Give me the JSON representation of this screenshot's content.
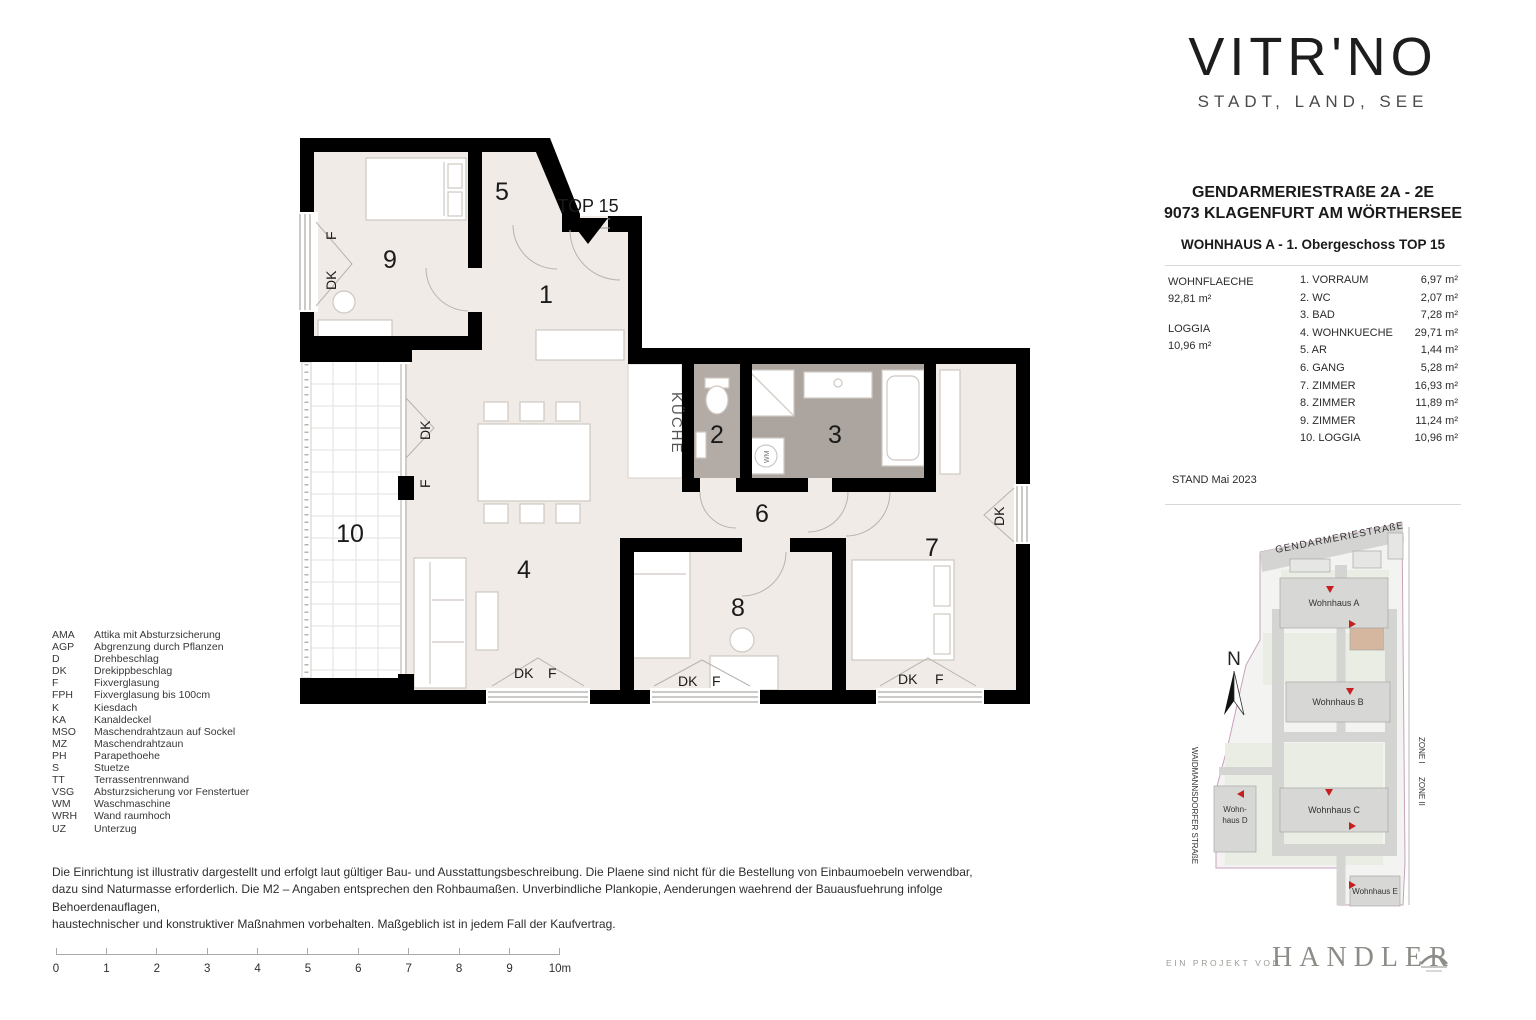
{
  "brand": {
    "name": "VITR'NO",
    "tagline": "STADT, LAND, SEE"
  },
  "title": {
    "line1": "GENDARMERIESTRAßE 2A - 2E",
    "line2": "9073 KLAGENFURT AM WÖRTHERSEE",
    "subtitle": "WOHNHAUS A - 1. Obergeschoss TOP 15"
  },
  "areas": {
    "wohnflaeche_label": "WOHNFLAECHE",
    "wohnflaeche_value": "92,81 m²",
    "loggia_label": "LOGGIA",
    "loggia_value": "10,96 m²"
  },
  "rooms": [
    {
      "name": "1. VORRAUM",
      "area": "6,97 m²"
    },
    {
      "name": "2. WC",
      "area": "2,07 m²"
    },
    {
      "name": "3. BAD",
      "area": "7,28 m²"
    },
    {
      "name": "4. WOHNKUECHE",
      "area": "29,71 m²"
    },
    {
      "name": "5. AR",
      "area": "1,44 m²"
    },
    {
      "name": "6. GANG",
      "area": "5,28 m²"
    },
    {
      "name": "7. ZIMMER",
      "area": "16,93 m²"
    },
    {
      "name": "8. ZIMMER",
      "area": "11,89 m²"
    },
    {
      "name": "9. ZIMMER",
      "area": "11,24 m²"
    },
    {
      "name": "10. LOGGIA",
      "area": "10,96 m²"
    }
  ],
  "stand": "STAND Mai 2023",
  "plan": {
    "top": "TOP 15",
    "kueche": "KÜCHE",
    "dk": "DK",
    "f": "F",
    "wm": "WM",
    "r1": "1",
    "r2": "2",
    "r3": "3",
    "r4": "4",
    "r5": "5",
    "r6": "6",
    "r7": "7",
    "r8": "8",
    "r9": "9",
    "r10": "10"
  },
  "legend": [
    {
      "abbr": "AMA",
      "text": "Attika mit Absturzsicherung"
    },
    {
      "abbr": "AGP",
      "text": "Abgrenzung durch Pflanzen"
    },
    {
      "abbr": "D",
      "text": "Drehbeschlag"
    },
    {
      "abbr": "DK",
      "text": "Drekippbeschlag"
    },
    {
      "abbr": "F",
      "text": "Fixverglasung"
    },
    {
      "abbr": "FPH",
      "text": "Fixverglasung bis 100cm"
    },
    {
      "abbr": "K",
      "text": "Kiesdach"
    },
    {
      "abbr": "KA",
      "text": "Kanaldeckel"
    },
    {
      "abbr": "MSO",
      "text": "Maschendrahtzaun auf Sockel"
    },
    {
      "abbr": "MZ",
      "text": "Maschendrahtzaun"
    },
    {
      "abbr": "PH",
      "text": "Parapethoehe"
    },
    {
      "abbr": "S",
      "text": "Stuetze"
    },
    {
      "abbr": "TT",
      "text": "Terrassentrennwand"
    },
    {
      "abbr": "VSG",
      "text": "Absturzsicherung vor Fenstertuer"
    },
    {
      "abbr": "WM",
      "text": "Waschmaschine"
    },
    {
      "abbr": "WRH",
      "text": "Wand raumhoch"
    },
    {
      "abbr": "UZ",
      "text": "Unterzug"
    }
  ],
  "disclaimer": [
    "Die Einrichtung ist illustrativ dargestellt und erfolgt laut gültiger Bau- und Ausstattungsbeschreibung. Die Plaene sind nicht für die Bestellung von Einbaumoebeln verwendbar,",
    "dazu sind Naturmasse erforderlich. Die M2 – Angaben entsprechen den Rohbaumaßen. Unverbindliche Plankopie, Aenderungen waehrend der Bauausfuehrung infolge Behoerdenauflagen,",
    "haustechnischer und konstruktiver Maßnahmen vorbehalten. Maßgeblich ist in jedem Fall der Kaufvertrag."
  ],
  "scalebar": {
    "ticks": [
      "0",
      "1",
      "2",
      "3",
      "4",
      "5",
      "6",
      "7",
      "8",
      "9",
      "10m"
    ]
  },
  "sitemap": {
    "street_top": "GENDARMERIESTRAßE",
    "street_left": "WAIDMANNSDORFER STRAßE",
    "zone1": "ZONE I",
    "zone2": "ZONE II",
    "north": "N",
    "wohnhaus_a": "Wohnhaus A",
    "wohnhaus_b": "Wohnhaus B",
    "wohnhaus_c": "Wohnhaus C",
    "wohnhaus_d1": "Wohn-",
    "wohnhaus_d2": "haus D",
    "wohnhaus_e": "Wohnhaus E"
  },
  "footer": {
    "prefix": "EIN PROJEKT VON",
    "name": "HANDLER"
  },
  "colors": {
    "wall": "#000000",
    "room_fill": "#f1ebe7",
    "bath_fill": "#aca49e",
    "wc_fill": "#b3aba5",
    "unit_highlight": "#d5b69e",
    "entrance_marker": "#c61f1f",
    "handler_gray": "#8d8d88"
  }
}
